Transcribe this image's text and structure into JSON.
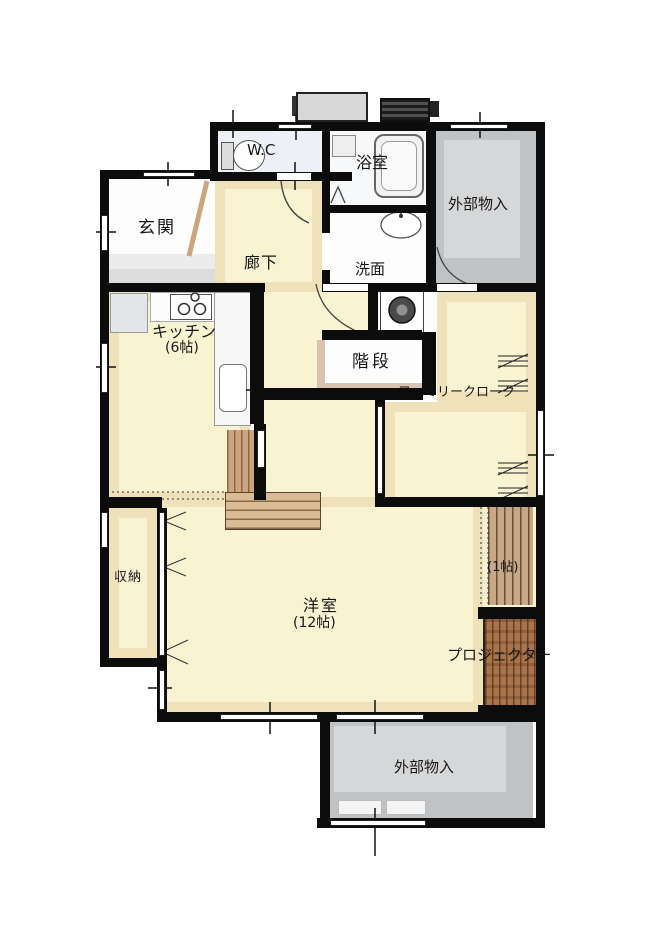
{
  "plan_type": "floor-plan",
  "rooms": {
    "genkan": {
      "label": "玄関"
    },
    "wc": {
      "label": "W.C"
    },
    "bathroom": {
      "label": "浴室"
    },
    "storage_top": {
      "label": "外部物入"
    },
    "hallway": {
      "label": "廊下"
    },
    "washroom": {
      "label": "洗面"
    },
    "kitchen": {
      "label": "キッチン",
      "size": "(6帖)"
    },
    "stairs": {
      "label": "階段"
    },
    "family_closet": {
      "label": "ファミリークローク"
    },
    "closet": {
      "label": "収納"
    },
    "living": {
      "label": "洋室",
      "size": "(12帖)"
    },
    "nook": {
      "size": "(1帖)"
    },
    "projector": {
      "label": "プロジェクター"
    },
    "storage_bottom": {
      "label": "外部物入"
    }
  },
  "colors": {
    "wall": "#0c0c0c",
    "floor_cream": "#faf3d2",
    "floor_band": "#efe2ba",
    "storage_gray": "#bfc3c5",
    "storage_gray_inner": "#d6d7d8",
    "wc_floor": "#edf1f5",
    "wood_step": "#d9bb96",
    "wood_dark": "#8a6848",
    "projector_wood": "#a9734b"
  }
}
